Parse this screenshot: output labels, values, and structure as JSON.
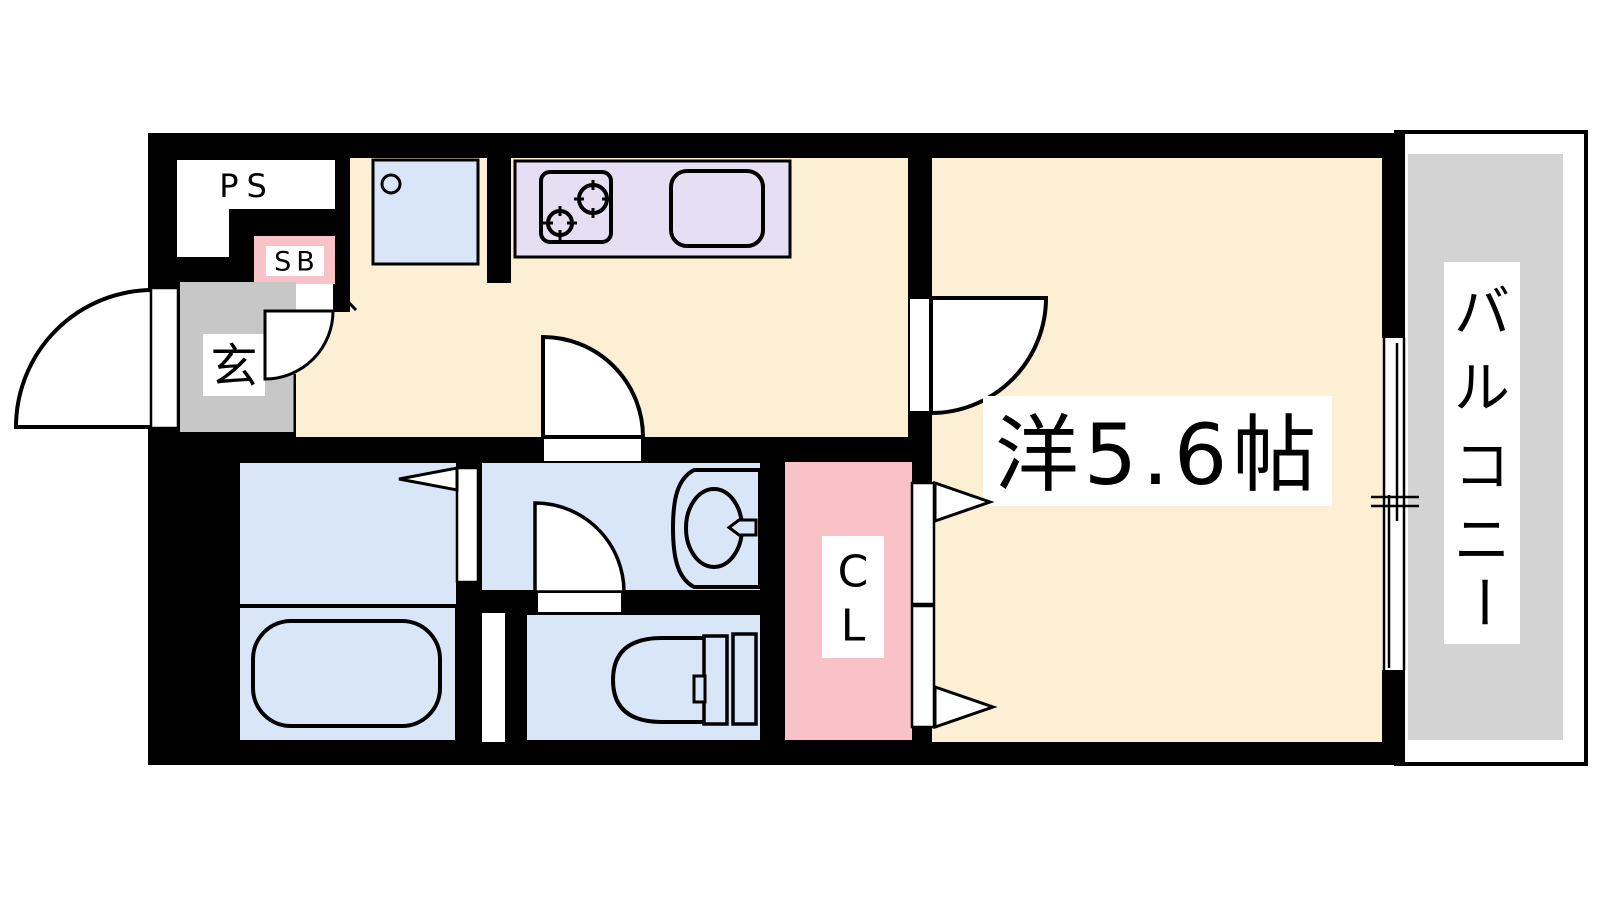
{
  "floorplan": {
    "type": "apartment-floor-plan",
    "labels": {
      "ps": "PS",
      "sb": "SB",
      "genkan": "玄",
      "main_room": "洋5.6帖",
      "closet_chars": [
        "C",
        "L"
      ],
      "balcony": "バルコニー",
      "balcony_chars": [
        "バ",
        "ル",
        "コ",
        "ニ",
        "ー"
      ]
    },
    "colors": {
      "wall": "#000000",
      "floor_beige": "#FCEFD3",
      "wet_blue": "#D8E6F8",
      "kitchen_purple": "#E6DFF3",
      "pink": "#F9C2C6",
      "genkan_gray": "#C7C7C7",
      "balcony_gray": "#D3D3D3",
      "white": "#FFFFFF"
    }
  }
}
